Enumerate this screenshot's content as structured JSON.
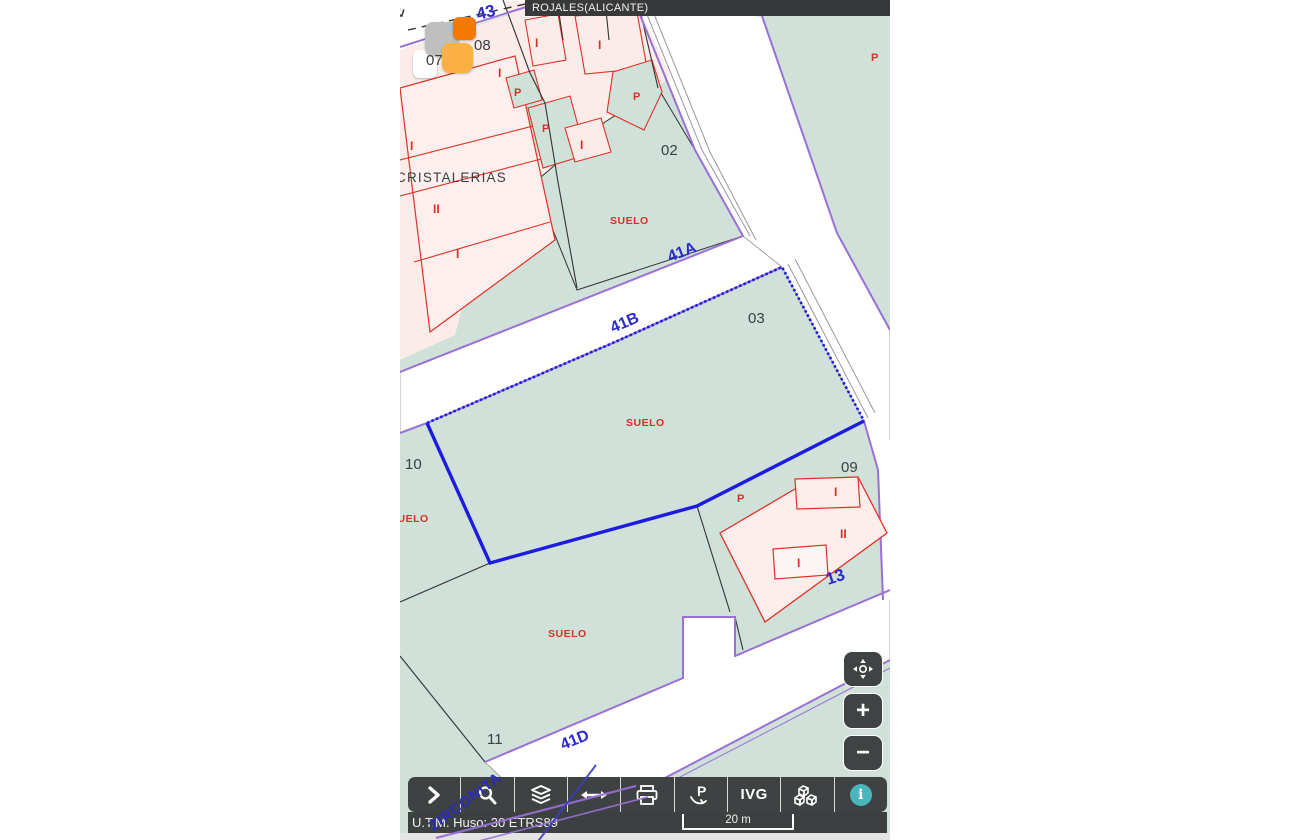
{
  "header": {
    "title": "ROJALES(ALICANTE)"
  },
  "markers": [
    {
      "label": "07"
    },
    {
      "label": "08"
    }
  ],
  "map_labels": [
    {
      "text": "43"
    },
    {
      "text": "E"
    },
    {
      "text": "CRISTALERIAS"
    },
    {
      "text": "I"
    },
    {
      "text": "II"
    },
    {
      "text": "I"
    },
    {
      "text": "I"
    },
    {
      "text": "I"
    },
    {
      "text": "I"
    },
    {
      "text": "P"
    },
    {
      "text": "P"
    },
    {
      "text": "P"
    },
    {
      "text": "I"
    },
    {
      "text": "02"
    },
    {
      "text": "SUELO"
    },
    {
      "text": "P"
    },
    {
      "text": "41A"
    },
    {
      "text": "41B"
    },
    {
      "text": "03"
    },
    {
      "text": "SUELO"
    },
    {
      "text": "10"
    },
    {
      "text": "SUELO"
    },
    {
      "text": "09"
    },
    {
      "text": "P"
    },
    {
      "text": "II"
    },
    {
      "text": "I"
    },
    {
      "text": "I"
    },
    {
      "text": "13"
    },
    {
      "text": "SUELO"
    },
    {
      "text": "11"
    },
    {
      "text": "41D"
    },
    {
      "text": "ZIRCONITA"
    }
  ],
  "zoom_controls": {
    "zoom_in": "+",
    "zoom_out": "−"
  },
  "toolbar": {
    "buttons": [
      {
        "name": "expand-panel"
      },
      {
        "name": "search"
      },
      {
        "name": "layers"
      },
      {
        "name": "measure"
      },
      {
        "name": "print"
      },
      {
        "name": "parcel-report",
        "label": "P"
      },
      {
        "name": "ivg",
        "label": "IVG"
      },
      {
        "name": "3d-view"
      },
      {
        "name": "info",
        "label": "i"
      }
    ]
  },
  "status_bar": {
    "utm": "U.T.M. Huso: 30 ETRS89",
    "scale_label": "20 m"
  },
  "colors": {
    "parcel_green": "#cfe1d8",
    "building_pink": "#fbecea",
    "building_outline": "#e03127",
    "street_purple": "#9a6fd6",
    "selection_blue": "#1c1ce0",
    "label_blue": "#2b2bd0",
    "label_red": "#d93025",
    "toolbar_bg": "#3e4243",
    "info_teal": "#49b6bc",
    "marker_orange": "#f57900",
    "marker_amber": "#fbb042",
    "marker_gray": "#bfbfbf"
  }
}
